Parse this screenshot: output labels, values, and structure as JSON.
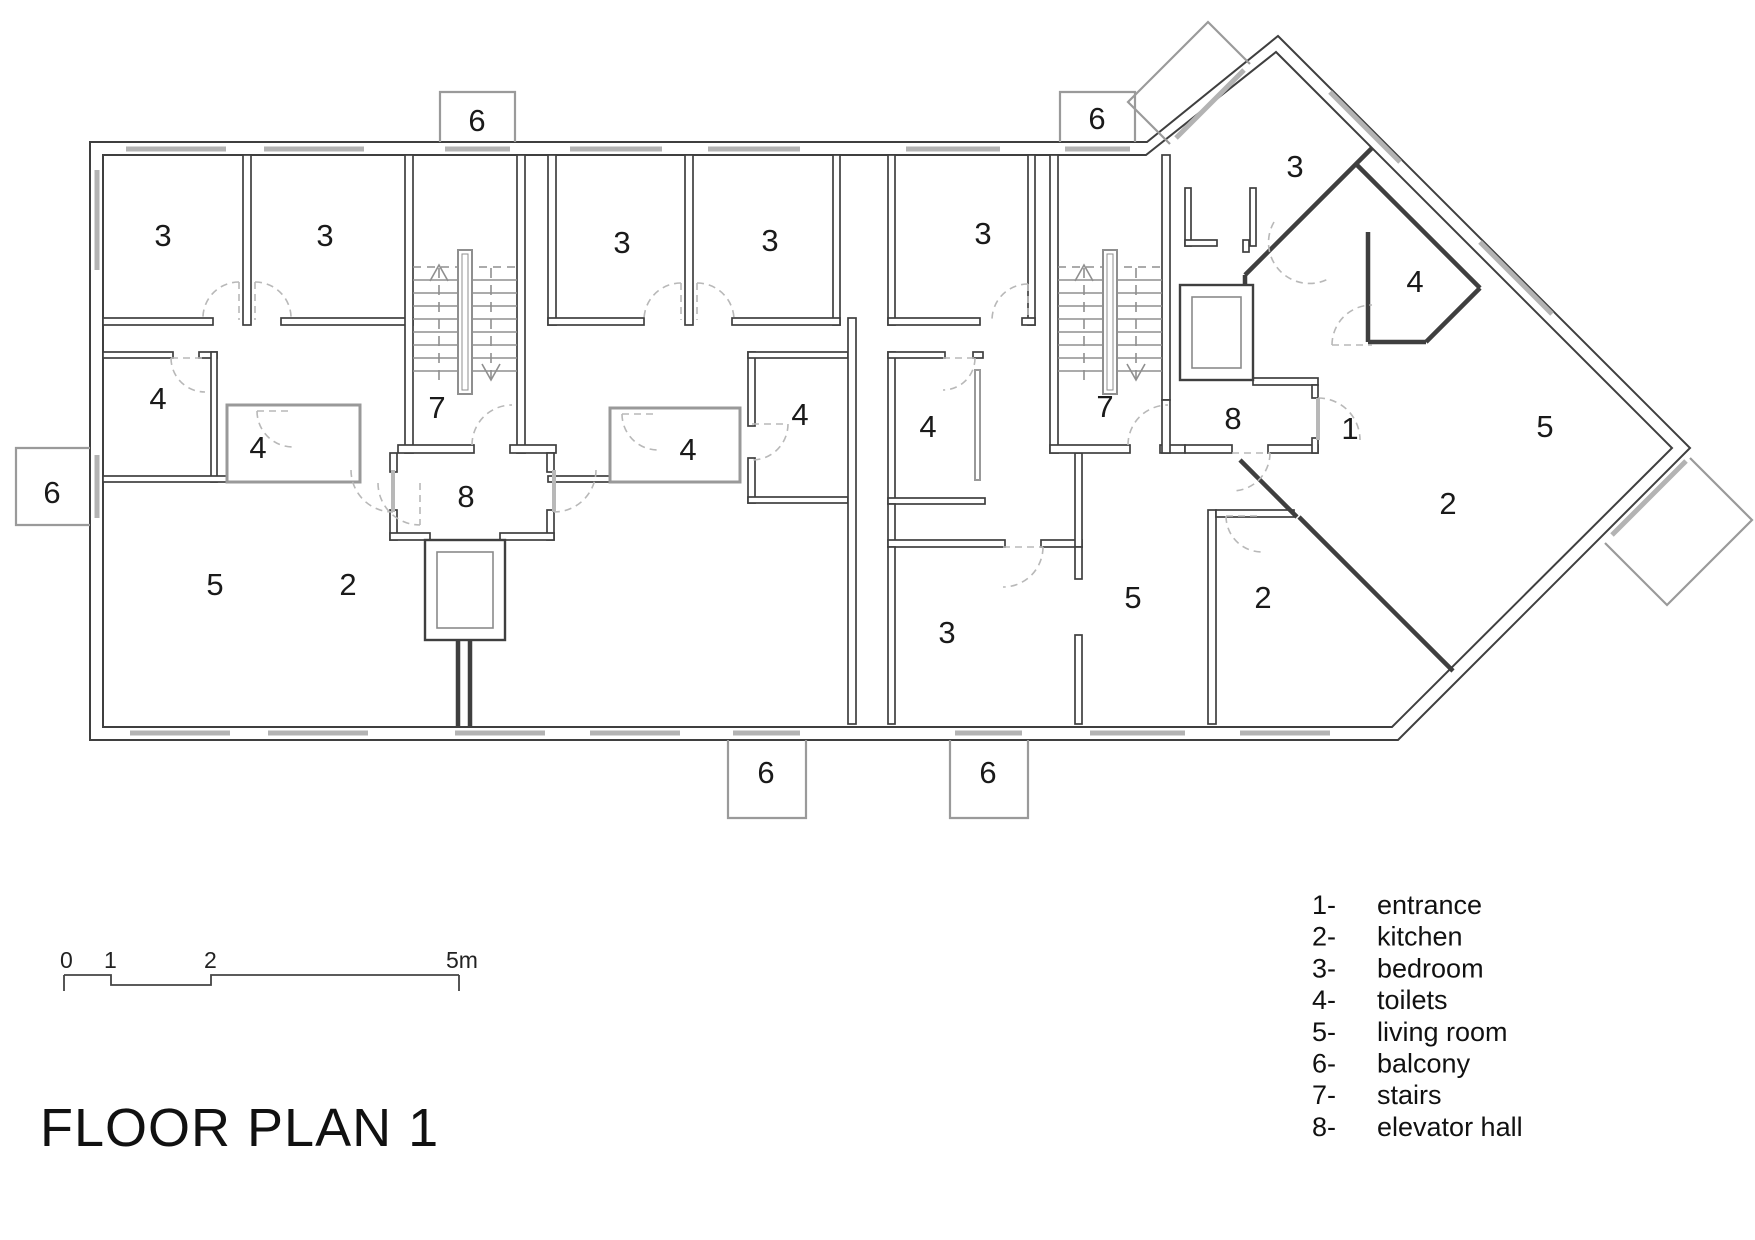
{
  "title": "FLOOR PLAN 1",
  "legend": {
    "items": [
      {
        "num": "1-",
        "label": "entrance"
      },
      {
        "num": "2-",
        "label": "kitchen"
      },
      {
        "num": "3-",
        "label": "bedroom"
      },
      {
        "num": "4-",
        "label": "toilets"
      },
      {
        "num": "5-",
        "label": "living room"
      },
      {
        "num": "6-",
        "label": "balcony"
      },
      {
        "num": "7-",
        "label": "stairs"
      },
      {
        "num": "8-",
        "label": "elevator hall"
      }
    ]
  },
  "scale_bar": {
    "labels": [
      {
        "t": "0",
        "x": 60
      },
      {
        "t": "1",
        "x": 104
      },
      {
        "t": "2",
        "x": 204
      },
      {
        "t": "5m",
        "x": 446
      }
    ]
  },
  "room_labels": [
    {
      "n": "3",
      "x": 163,
      "y": 235
    },
    {
      "n": "3",
      "x": 325,
      "y": 235
    },
    {
      "n": "6",
      "x": 477,
      "y": 120
    },
    {
      "n": "7",
      "x": 437,
      "y": 407
    },
    {
      "n": "4",
      "x": 158,
      "y": 398
    },
    {
      "n": "4",
      "x": 258,
      "y": 447
    },
    {
      "n": "6",
      "x": 52,
      "y": 492
    },
    {
      "n": "8",
      "x": 466,
      "y": 496
    },
    {
      "n": "5",
      "x": 215,
      "y": 584
    },
    {
      "n": "2",
      "x": 348,
      "y": 584
    },
    {
      "n": "3",
      "x": 622,
      "y": 242
    },
    {
      "n": "3",
      "x": 770,
      "y": 240
    },
    {
      "n": "4",
      "x": 688,
      "y": 449
    },
    {
      "n": "4",
      "x": 800,
      "y": 414
    },
    {
      "n": "3",
      "x": 983,
      "y": 233
    },
    {
      "n": "4",
      "x": 928,
      "y": 426
    },
    {
      "n": "6",
      "x": 1097,
      "y": 118
    },
    {
      "n": "7",
      "x": 1105,
      "y": 406
    },
    {
      "n": "8",
      "x": 1233,
      "y": 418
    },
    {
      "n": "3",
      "x": 947,
      "y": 632
    },
    {
      "n": "5",
      "x": 1133,
      "y": 597
    },
    {
      "n": "2",
      "x": 1263,
      "y": 597
    },
    {
      "n": "6",
      "x": 766,
      "y": 772
    },
    {
      "n": "6",
      "x": 988,
      "y": 772
    },
    {
      "n": "3",
      "x": 1295,
      "y": 166
    },
    {
      "n": "4",
      "x": 1415,
      "y": 281
    },
    {
      "n": "1",
      "x": 1350,
      "y": 428
    },
    {
      "n": "5",
      "x": 1545,
      "y": 426
    },
    {
      "n": "2",
      "x": 1448,
      "y": 503
    }
  ],
  "colors": {
    "wall": "#3f3f3f",
    "light": "#b3b3b3",
    "door": "#b8b8b8",
    "stair": "#8f8f8f",
    "balcony": "#9a9a9a"
  }
}
